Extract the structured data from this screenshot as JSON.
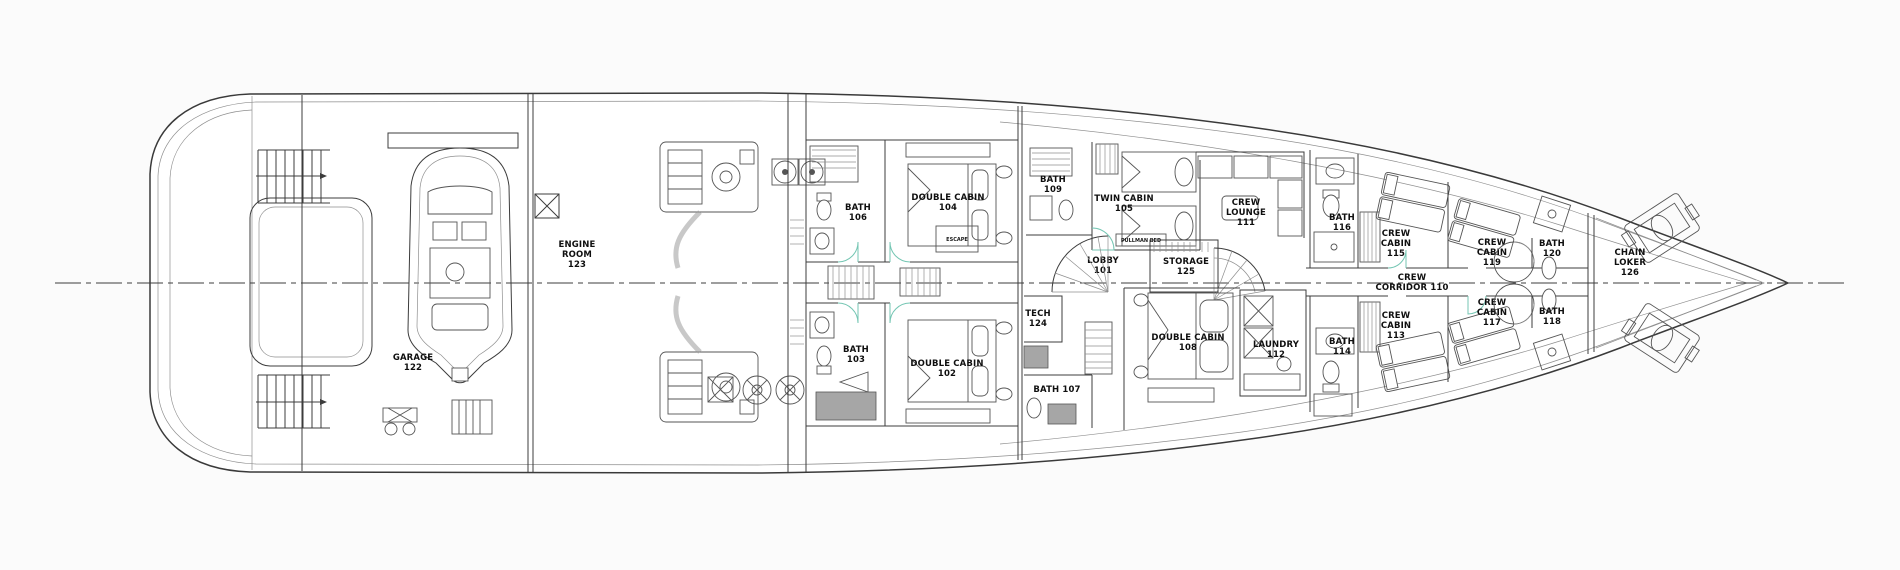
{
  "plan": {
    "type": "yacht lower deck floor plan",
    "colors": {
      "background": "#fbfbfb",
      "line": "#3c3c3c",
      "light_line": "#8f8f8f",
      "fixture_gray": "#a6a6a6",
      "door_accent": "#74c6b3",
      "text": "#0f0f0f"
    },
    "rooms": {
      "lobby": {
        "lines": [
          "LOBBY",
          "101"
        ]
      },
      "double_cabin_102": {
        "lines": [
          "DOUBLE CABIN",
          "102"
        ]
      },
      "bath_103": {
        "lines": [
          "BATH",
          "103"
        ]
      },
      "double_cabin_104": {
        "lines": [
          "DOUBLE CABIN",
          "104"
        ]
      },
      "twin_cabin_105": {
        "lines": [
          "TWIN CABIN",
          "105"
        ]
      },
      "bath_106": {
        "lines": [
          "BATH",
          "106"
        ]
      },
      "bath_107": {
        "lines": [
          "BATH 107"
        ]
      },
      "double_cabin_108": {
        "lines": [
          "DOUBLE CABIN",
          "108"
        ]
      },
      "bath_109": {
        "lines": [
          "BATH",
          "109"
        ]
      },
      "crew_corridor_110": {
        "lines": [
          "CREW",
          "CORRIDOR 110"
        ]
      },
      "crew_lounge_111": {
        "lines": [
          "CREW",
          "LOUNGE",
          "111"
        ]
      },
      "laundry_112": {
        "lines": [
          "LAUNDRY",
          "112"
        ]
      },
      "crew_cabin_113": {
        "lines": [
          "CREW",
          "CABIN",
          "113"
        ]
      },
      "bath_114": {
        "lines": [
          "BATH",
          "114"
        ]
      },
      "crew_cabin_115": {
        "lines": [
          "CREW",
          "CABIN",
          "115"
        ]
      },
      "bath_116": {
        "lines": [
          "BATH",
          "116"
        ]
      },
      "crew_cabin_117": {
        "lines": [
          "CREW",
          "CABIN",
          "117"
        ]
      },
      "bath_118": {
        "lines": [
          "BATH",
          "118"
        ]
      },
      "crew_cabin_119": {
        "lines": [
          "CREW",
          "CABIN",
          "119"
        ]
      },
      "bath_120": {
        "lines": [
          "BATH",
          "120"
        ]
      },
      "garage_122": {
        "lines": [
          "GARAGE",
          "122"
        ]
      },
      "engine_room_123": {
        "lines": [
          "ENGINE",
          "ROOM",
          "123"
        ]
      },
      "tech_124": {
        "lines": [
          "TECH",
          "124"
        ]
      },
      "storage_125": {
        "lines": [
          "STORAGE",
          "125"
        ]
      },
      "chain_locker_126": {
        "lines": [
          "CHAIN",
          "LOKER",
          "126"
        ]
      }
    },
    "notes": {
      "pullman_bed": "PULLMAN BED",
      "escape": "ESCAPE"
    }
  }
}
